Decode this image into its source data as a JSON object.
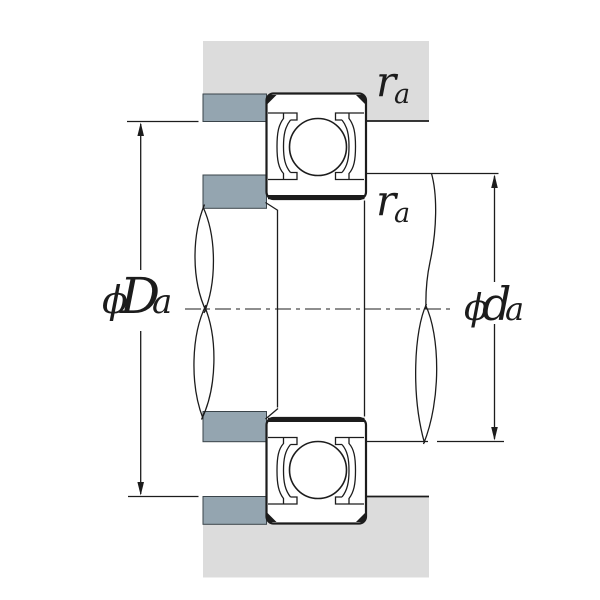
{
  "drawing": {
    "type": "bearing-mounting-cross-section",
    "labels": {
      "housing_abutment_diameter": {
        "phi": "ϕ",
        "letter": "D",
        "subscript": "a"
      },
      "shaft_abutment_diameter": {
        "phi": "ϕ",
        "letter": "d",
        "subscript": "a"
      },
      "fillet_radius_housing": {
        "letter": "r",
        "subscript": "a"
      },
      "fillet_radius_shaft": {
        "letter": "r",
        "subscript": "a"
      }
    },
    "colors": {
      "background": "#ffffff",
      "housing_fill": "#dcdcdc",
      "abutment_fill": "#94a5b0",
      "line": "#1c1c1c"
    }
  }
}
